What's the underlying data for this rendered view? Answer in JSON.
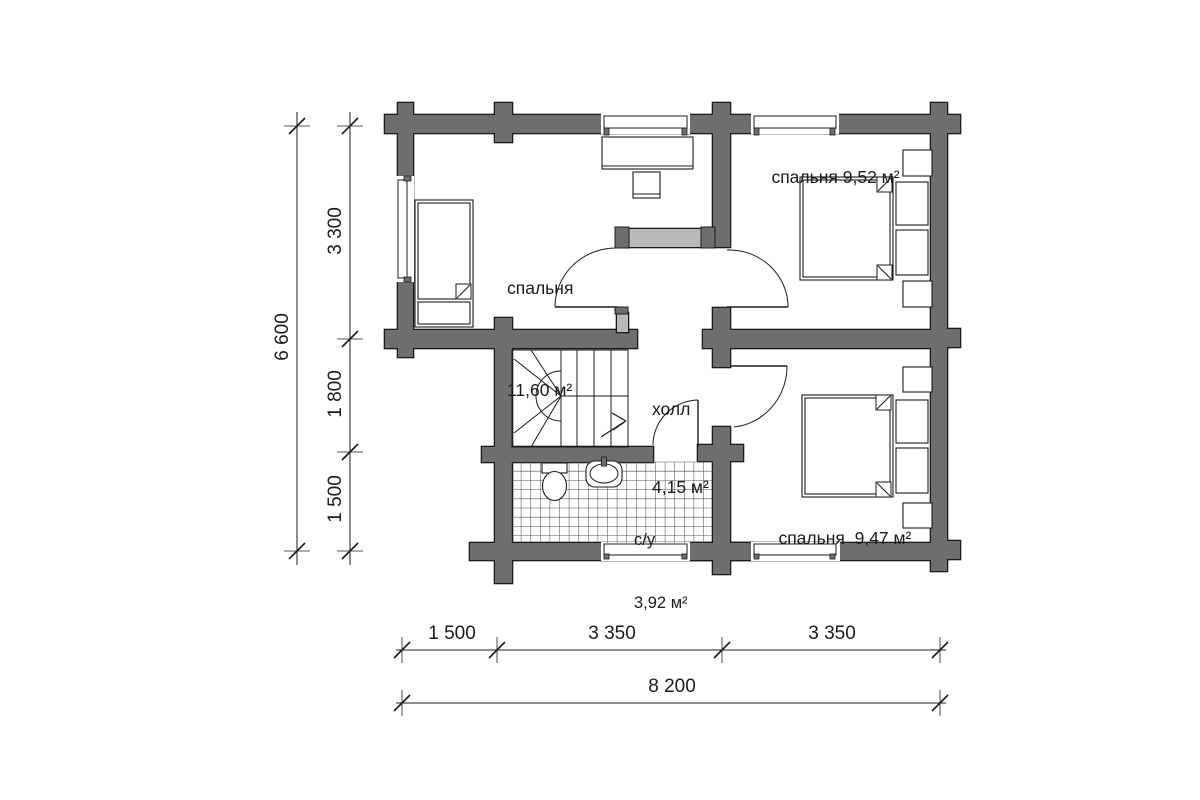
{
  "rooms": [
    {
      "id": "bedroom-left",
      "label_line1": "спальня",
      "label_line2": "11,60 м²"
    },
    {
      "id": "bedroom-top-right",
      "label": "спальня 9,52 м²"
    },
    {
      "id": "hall",
      "label_line1": "холл",
      "label_line2": "4,15 м²"
    },
    {
      "id": "bathroom",
      "label_line1": "с/у",
      "label_line2": "3,92 м²"
    },
    {
      "id": "bedroom-bottom-right",
      "label": "спальня  9,47 м²"
    }
  ],
  "dimensions": {
    "left_total": "6 600",
    "left_segment_top": "3 300",
    "left_segment_mid": "1 800",
    "left_segment_bottom": "1 500",
    "bottom_segment_1": "1 500",
    "bottom_segment_2": "3 350",
    "bottom_segment_3": "3 350",
    "bottom_total": "8 200"
  },
  "colors": {
    "wall_dark": "#6e6e6e",
    "wall_partition": "#b9b9b9",
    "line": "#1b1b1b",
    "background": "#ffffff"
  }
}
